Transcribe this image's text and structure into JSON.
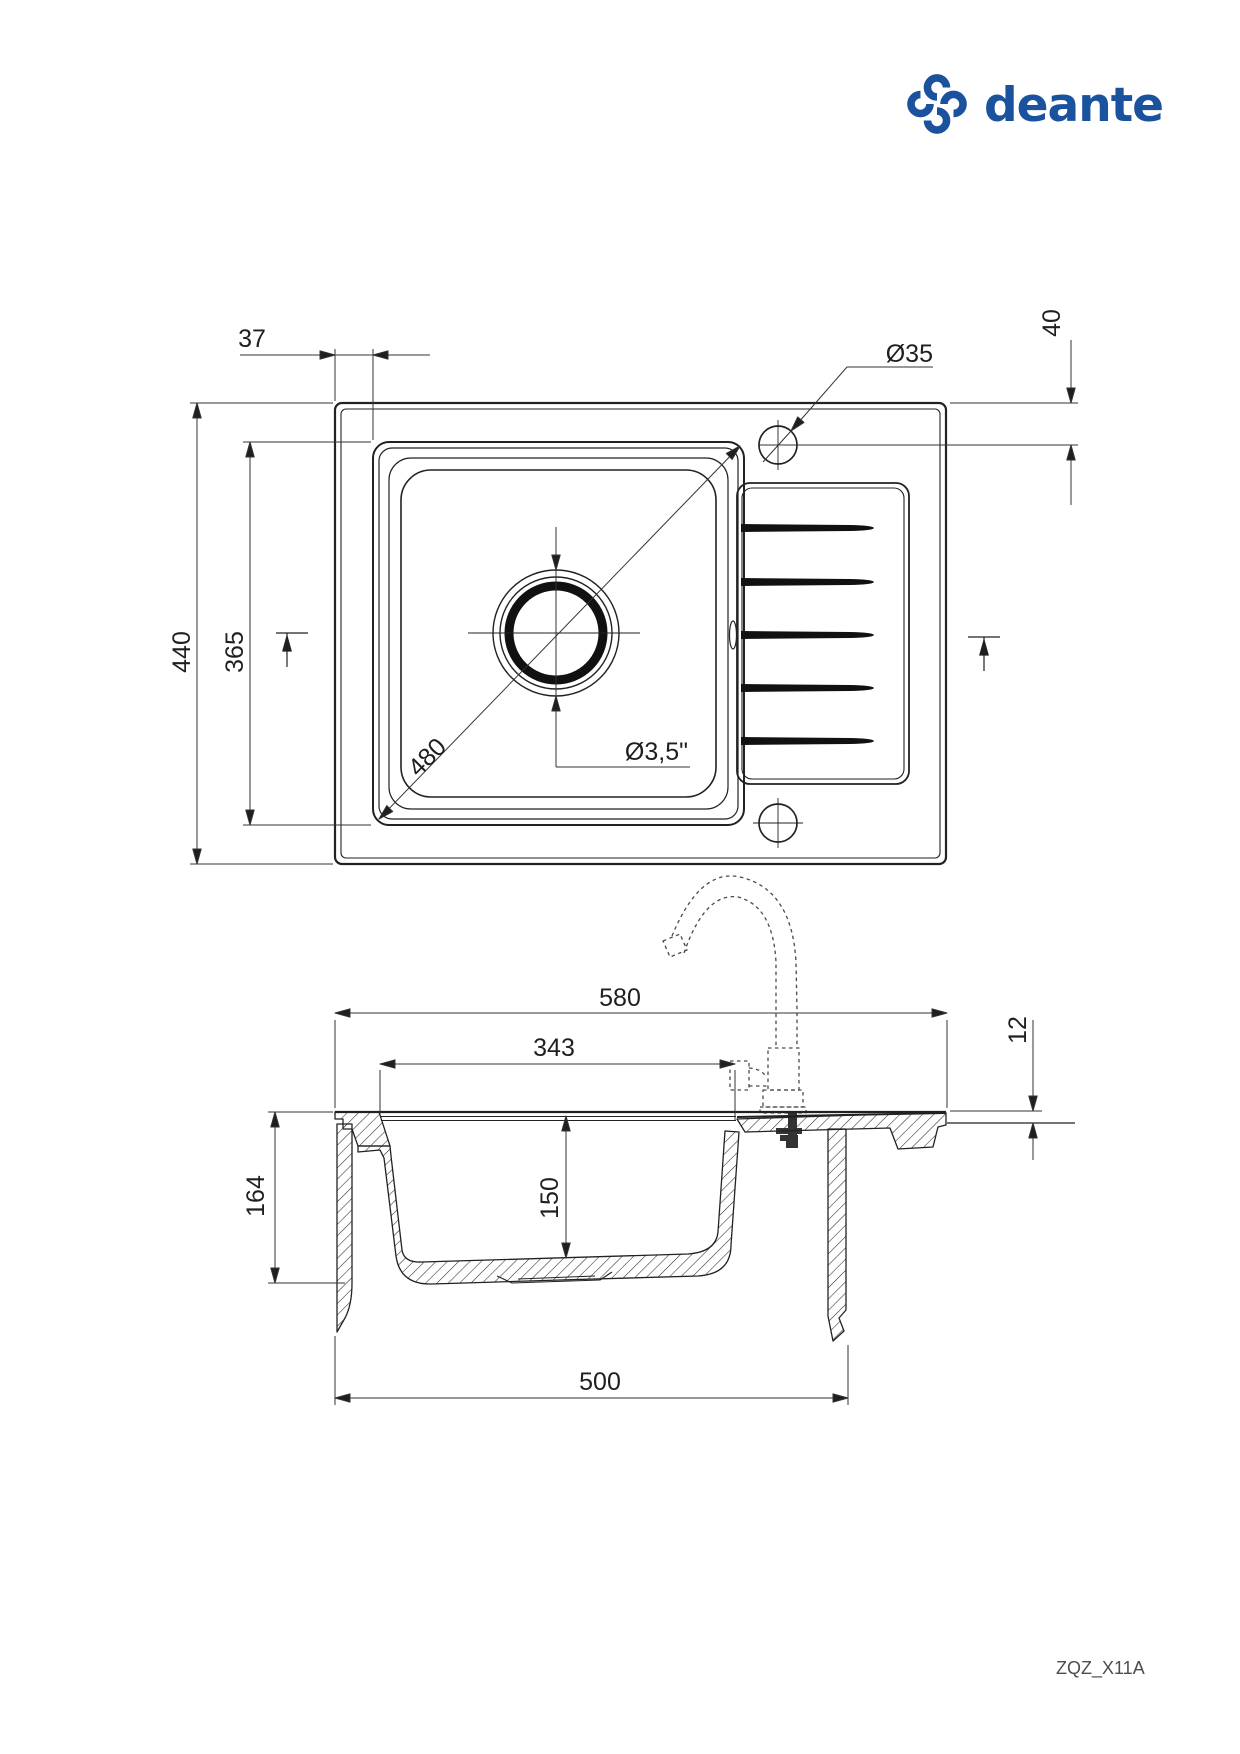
{
  "brand": {
    "logo_text": "deante",
    "logo_color": "#1a529e"
  },
  "title_block": {
    "model_code": "ZQZ_X11A"
  },
  "top_view": {
    "dim_left_offset": "37",
    "dim_tap_hole_dia": "Ø35",
    "dim_tap_hole_from_edge": "40",
    "dim_overall_depth": "440",
    "dim_bowl_length": "365",
    "dim_bowl_diagonal": "480",
    "dim_drain_dia": "Ø3,5\""
  },
  "section_view": {
    "dim_overall_width": "580",
    "dim_tap_axis": "343",
    "dim_rim_height": "12",
    "dim_overall_height": "164",
    "dim_bowl_depth": "150",
    "dim_cutout_width": "500"
  }
}
